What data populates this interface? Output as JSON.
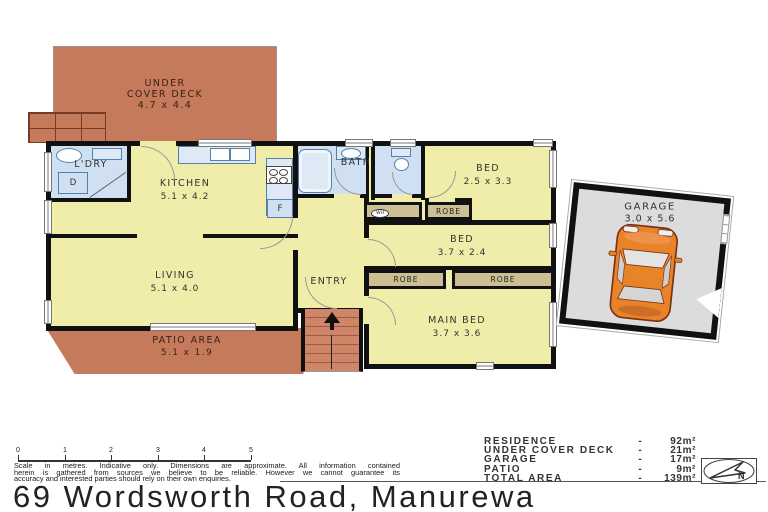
{
  "address": "69 Wordsworth Road, Manurewa",
  "plan": {
    "rooms": {
      "deck": {
        "l1": "UNDER",
        "l2": "COVER DECK",
        "dims": "4.7 x 4.4"
      },
      "ldry": {
        "name": "L'DRY"
      },
      "kitchen": {
        "name": "KITCHEN",
        "dims": "5.1 x 4.2"
      },
      "living": {
        "name": "LIVING",
        "dims": "5.1 x 4.0"
      },
      "bath": {
        "name": "BATH"
      },
      "bed1": {
        "name": "BED",
        "dims": "2.5 x 3.3"
      },
      "bed2": {
        "name": "BED",
        "dims": "3.7 x 2.4"
      },
      "main_bed": {
        "name": "MAIN BED",
        "dims": "3.7 x 3.6"
      },
      "entry": {
        "name": "ENTRY"
      },
      "patio": {
        "name": "PATIO AREA",
        "dims": "5.1 x 1.9"
      },
      "garage": {
        "name": "GARAGE",
        "dims": "3.0 x 5.6"
      }
    },
    "fixtures": {
      "robe": "ROBE",
      "water_heater": "WH",
      "dryer": "D",
      "fridge": "F"
    }
  },
  "legend": {
    "rows": [
      {
        "label": "RESIDENCE",
        "sep": "-",
        "value": "92m²"
      },
      {
        "label": "UNDER COVER DECK",
        "sep": "-",
        "value": "21m²"
      },
      {
        "label": "GARAGE",
        "sep": "-",
        "value": "17m²"
      },
      {
        "label": "PATIO",
        "sep": "-",
        "value": "9m²"
      },
      {
        "label": "TOTAL AREA",
        "sep": "-",
        "value": "139m²"
      }
    ]
  },
  "scale_bar": {
    "ticks": [
      "0",
      "1",
      "2",
      "3",
      "4",
      "5"
    ],
    "caption_lines": [
      "Scale in metres. Indicative only. Dimensions are approximate. All information contained",
      "herein is gathered from sources we believe to be reliable. However we cannot guarantee its",
      "accuracy and interested parties should rely on their own enquiries."
    ]
  },
  "compass": {
    "label": "N"
  },
  "colors": {
    "deck": "#c57a5b",
    "room": "#efeda9",
    "wet": "#cfe0f2",
    "robe": "#cdbf94",
    "wall": "#111111",
    "garage_floor": "#dcdcdc",
    "car": "#e8832a"
  }
}
